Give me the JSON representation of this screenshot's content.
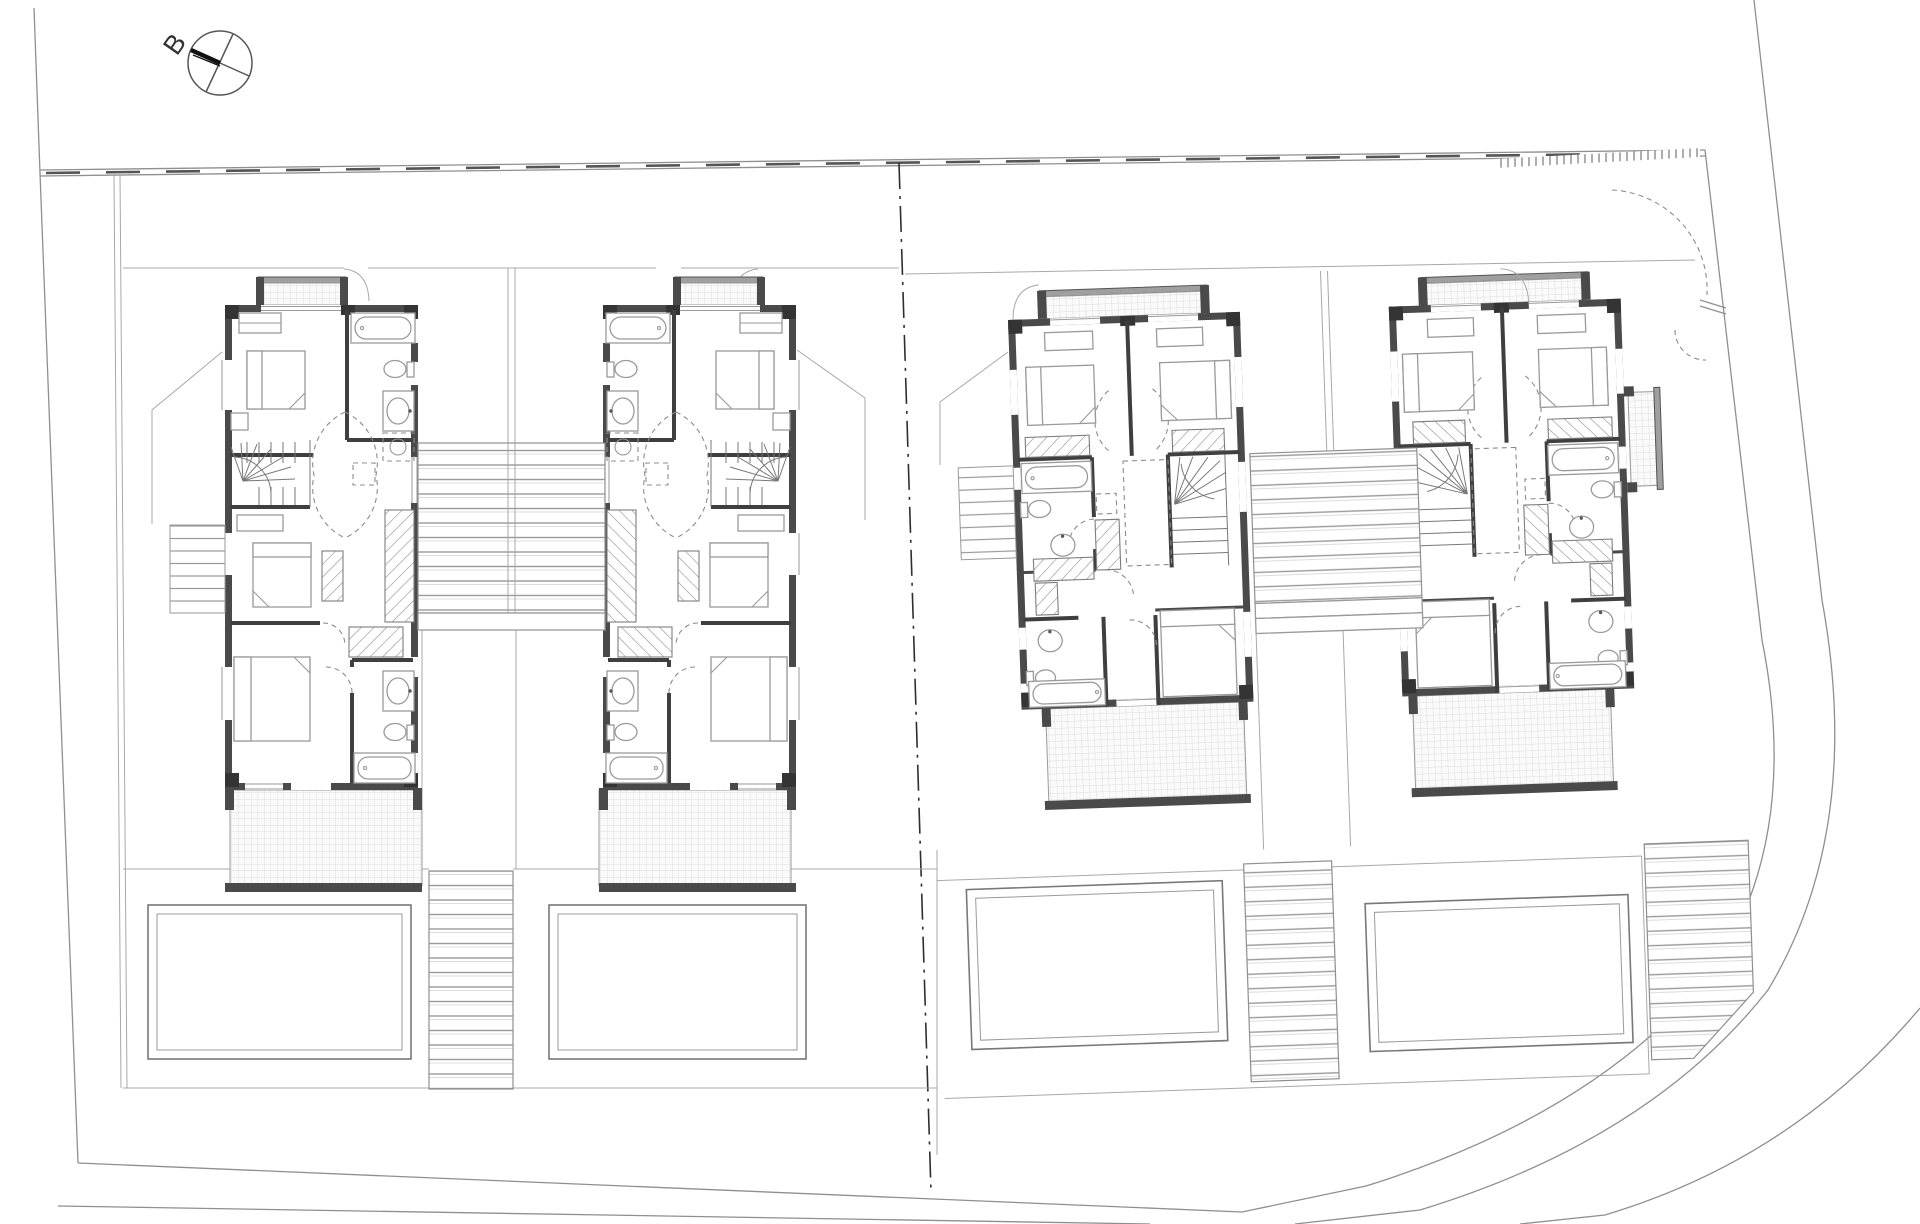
{
  "drawing": {
    "type": "architectural-site-plan",
    "title": "Upper floor plan of four detached villas with pools",
    "labels": {
      "section_marker": "B"
    },
    "site": {
      "north_marker": "circle with crossed diameters and thick section pointer, labelled B",
      "property_divider": "vertical dash-dot lot line between west and east semi-plots",
      "top_boundary": "double boundary line with long dash ticks",
      "road": "angled road band along east side curving around the south-east corner",
      "gate": "dashed driveway gate swing at the north-east entrance with hatched verge strip"
    },
    "houses": [
      {
        "id": "unit-1",
        "pair": "west",
        "mirrored": false,
        "rotation_deg": 0,
        "rooms": [
          "front balcony",
          "bedroom 1",
          "bathroom 1",
          "hall",
          "winder stair",
          "bedroom 2",
          "bedroom 3",
          "en-suite bathroom",
          "rear terrace"
        ],
        "fixtures": [
          "bathtub",
          "toilet",
          "washbasin",
          "washing machine",
          "3 beds",
          "wardrobes (hatched)",
          "dashed rooflight square",
          "dashed door swings"
        ]
      },
      {
        "id": "unit-2",
        "pair": "west",
        "mirrored": true,
        "rotation_deg": 0,
        "rooms": [
          "front balcony",
          "bedroom 1",
          "bathroom 1",
          "hall",
          "winder stair",
          "bedroom 2",
          "bedroom 3",
          "en-suite bathroom",
          "rear terrace"
        ],
        "fixtures": [
          "bathtub",
          "toilet",
          "washbasin",
          "washing machine",
          "3 beds",
          "wardrobes (hatched)"
        ]
      },
      {
        "id": "unit-3",
        "pair": "east",
        "mirrored": false,
        "rotation_deg": -2,
        "rooms": [
          "front balcony",
          "bedroom 1",
          "bedroom 2",
          "bathroom",
          "winder stair",
          "double-height void (dashed)",
          "bedroom 3",
          "en-suite bathroom",
          "rear terrace"
        ],
        "fixtures": [
          "bathtub",
          "toilet",
          "washbasin",
          "3 beds",
          "wardrobes (hatched)"
        ]
      },
      {
        "id": "unit-4",
        "pair": "east",
        "mirrored": true,
        "rotation_deg": -2,
        "rooms": [
          "front balcony",
          "side balcony",
          "bedroom 1",
          "bedroom 2",
          "bathroom",
          "winder stair",
          "double-height void (dashed)",
          "bedroom 3",
          "en-suite bathroom",
          "rear terrace"
        ],
        "fixtures": [
          "bathtub",
          "toilet",
          "washbasin",
          "3 beds",
          "wardrobes (hatched)"
        ]
      }
    ],
    "outdoor": {
      "pools": [
        {
          "id": "pool-1",
          "garden": "unit-1"
        },
        {
          "id": "pool-2",
          "garden": "unit-2"
        },
        {
          "id": "pool-3",
          "garden": "unit-3"
        },
        {
          "id": "pool-4",
          "garden": "unit-4"
        }
      ],
      "decks": [
        "stepped timber deck between unit-1 and unit-2",
        "stepped timber deck between unit-3 and unit-4"
      ],
      "garden_steps": [
        "entry steps west of unit-1",
        "entry steps west of unit-3",
        "pool steps between gardens 1-2",
        "pool steps between gardens 3-4",
        "pool steps east of garden 4 (angled end)"
      ],
      "terraces": 4
    },
    "palette": {
      "paper": "#ffffff",
      "wall": "#4a4a4a",
      "pier": "#343434",
      "furniture": "#9a9a9a",
      "site_line": "#8f8f8f",
      "hatch": "#8f8f8f",
      "tile_grid": "#dedede",
      "divider": "#2e2e2e"
    }
  }
}
